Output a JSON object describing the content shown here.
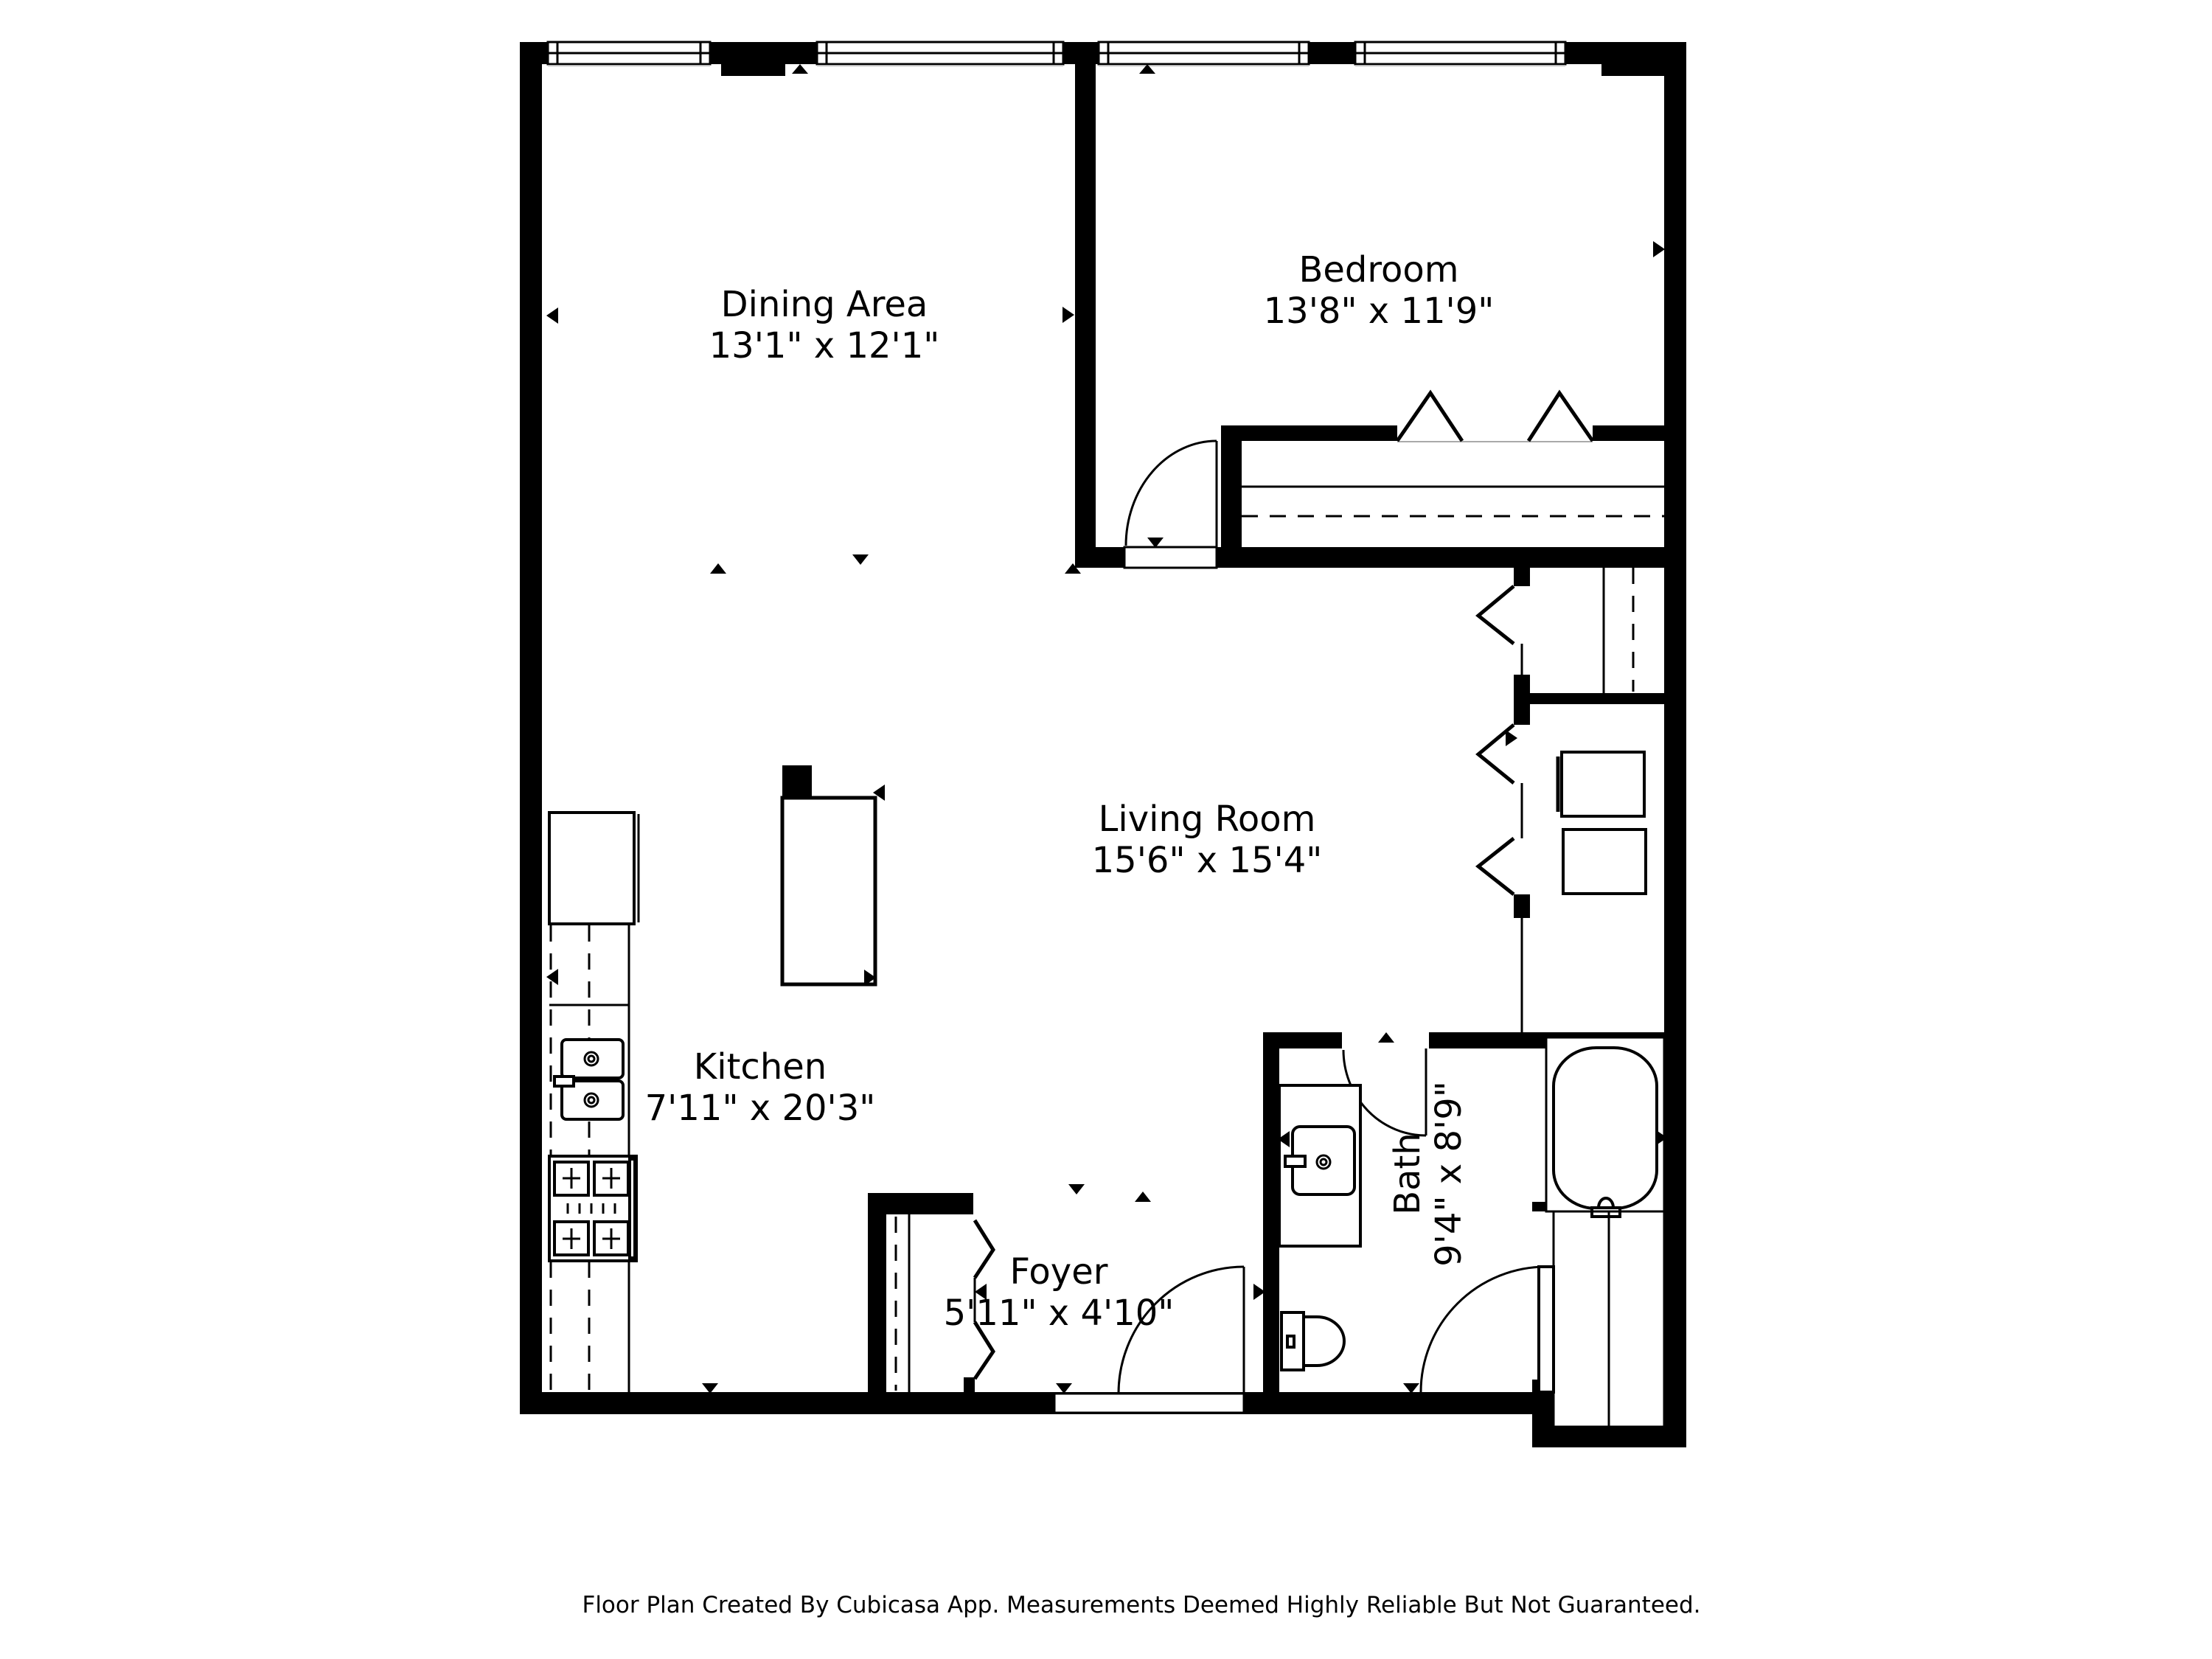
{
  "colors": {
    "wall": "#000000",
    "background": "#ffffff",
    "text": "#000000"
  },
  "rooms": [
    {
      "name": "Dining Area",
      "dimensions": "13'1\" x 12'1\""
    },
    {
      "name": "Bedroom",
      "dimensions": "13'8\" x 11'9\""
    },
    {
      "name": "Living Room",
      "dimensions": "15'6\" x 15'4\""
    },
    {
      "name": "Kitchen",
      "dimensions": "7'11\" x 20'3\""
    },
    {
      "name": "Foyer",
      "dimensions": "5'11\" x 4'10\""
    },
    {
      "name": "Bath",
      "dimensions": "9'4\" x 8'9\""
    }
  ],
  "footer": {
    "disclaimer": "Floor Plan Created By Cubicasa App. Measurements Deemed Highly Reliable But Not Guaranteed."
  }
}
